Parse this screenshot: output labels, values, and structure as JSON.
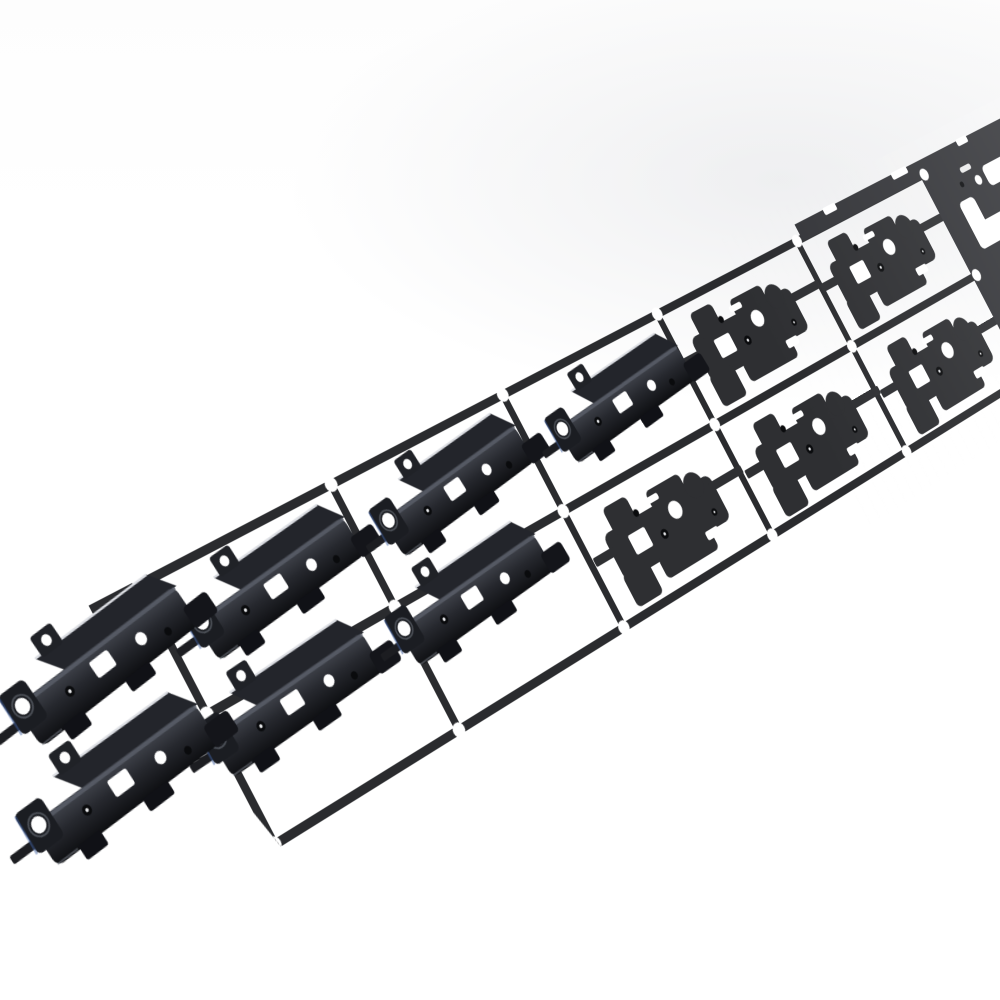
{
  "scene": {
    "type": "product-photo",
    "subject": "black progressive-die stamped metal carrier strip with notebook hinge bracket parts",
    "background": "plain white studio background",
    "strip": {
      "rows": 2,
      "columns": 8,
      "pitch": 280,
      "row_height": 150,
      "rail_width": 10,
      "cut_end": "lower-left",
      "direction": "diagonal lower-left to upper-right",
      "stations": [
        {
          "type": "formed",
          "overhang": true
        },
        {
          "type": "formed"
        },
        {
          "type": "mixed"
        },
        {
          "type": "blank"
        },
        {
          "type": "blank"
        },
        {
          "type": "pierced"
        },
        {
          "type": "pierced"
        },
        {
          "type": "pierced"
        }
      ],
      "formed_part_pairs": 4,
      "flat_blank_parts": 5,
      "pilot_holes": 24
    },
    "palette": {
      "background": "#ffffff",
      "metal": "#2e2f32",
      "metal_far": "#333438",
      "rail": "#2a2b2e",
      "formed_dark": "#0e0f12",
      "formed_mid": "#23252b",
      "formed_light": "#41444c",
      "specular": "#dcdee3",
      "hole_dark": "#0a0b0d",
      "pip_light": "#e8e9eb",
      "fringe_blue": "#3d5d9e",
      "pilot_hole": "#ffffff"
    }
  }
}
